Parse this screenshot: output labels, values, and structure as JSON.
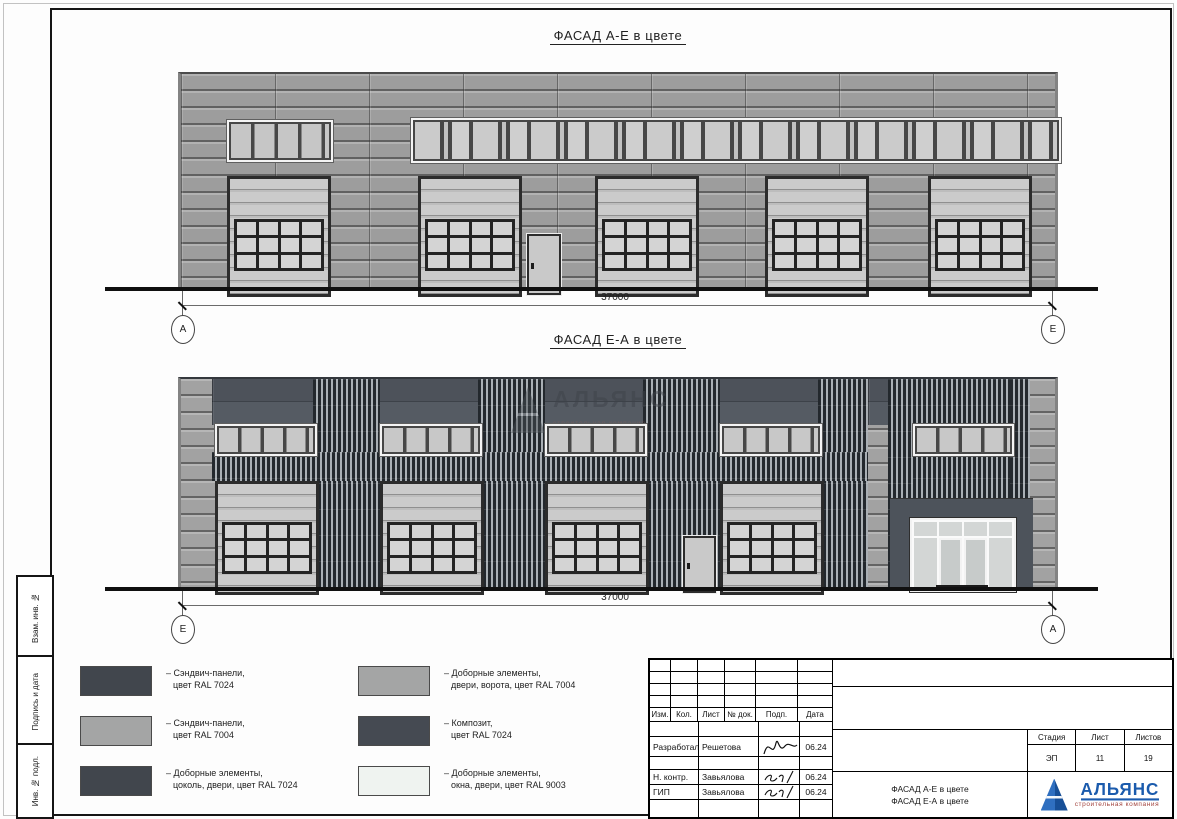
{
  "sheet": {
    "facade1": {
      "title": "ФАСАД А-Е в цвете",
      "dimension": "37000",
      "axis_left": "А",
      "axis_right": "Е"
    },
    "facade2": {
      "title": "ФАСАД Е-А в цвете",
      "dimension": "37000",
      "axis_left": "Е",
      "axis_right": "А",
      "watermark": "АЛЬЯНС",
      "watermark_sub": "строительная компания"
    },
    "legend": {
      "items": [
        {
          "color": "#41464d",
          "line1": "– Сэндвич-панели,",
          "line2": "цвет RAL 7024"
        },
        {
          "color": "#a4a5a5",
          "line1": "– Сэндвич-панели,",
          "line2": "цвет RAL 7004"
        },
        {
          "color": "#41464d",
          "line1": "– Доборные элементы,",
          "line2": "цоколь, двери, цвет RAL 7024"
        },
        {
          "color": "#a4a5a5",
          "line1": "– Доборные элементы,",
          "line2": "двери, ворота, цвет RAL 7004"
        },
        {
          "color": "#454a52",
          "line1": "– Композит,",
          "line2": "цвет RAL 7024"
        },
        {
          "color": "#eff3f0",
          "line1": "– Доборные элементы,",
          "line2": "окна, двери, цвет RAL 9003"
        }
      ]
    },
    "margin_labels": [
      "Взам. инв. №",
      "Подпись и дата",
      "Инв. № подл."
    ],
    "title_block": {
      "columns": [
        "Изм.",
        "Кол.",
        "Лист",
        "№ док.",
        "Подп.",
        "Дата"
      ],
      "rows": [
        {
          "role": "Разработал",
          "name": "Решетова",
          "date": "06.24"
        },
        {
          "role": "Н. контр.",
          "name": "Завьялова",
          "date": "06.24"
        },
        {
          "role": "ГИП",
          "name": "Завьялова",
          "date": "06.24"
        }
      ],
      "stage_label": "Стадия",
      "sheet_label": "Лист",
      "sheets_label": "Листов",
      "stage": "ЭП",
      "sheet_no": "11",
      "sheets_total": "19",
      "doc_line1": "ФАСАД А-Е в цвете",
      "doc_line2": "ФАСАД Е-А в цвете",
      "company": "АЛЬЯНС",
      "company_sub": "строительная компания"
    },
    "colors": {
      "ral7024": "#41464d",
      "ral7004": "#a4a5a5",
      "ral9003": "#eff3f0",
      "logo_blue": "#1b5bad"
    }
  }
}
